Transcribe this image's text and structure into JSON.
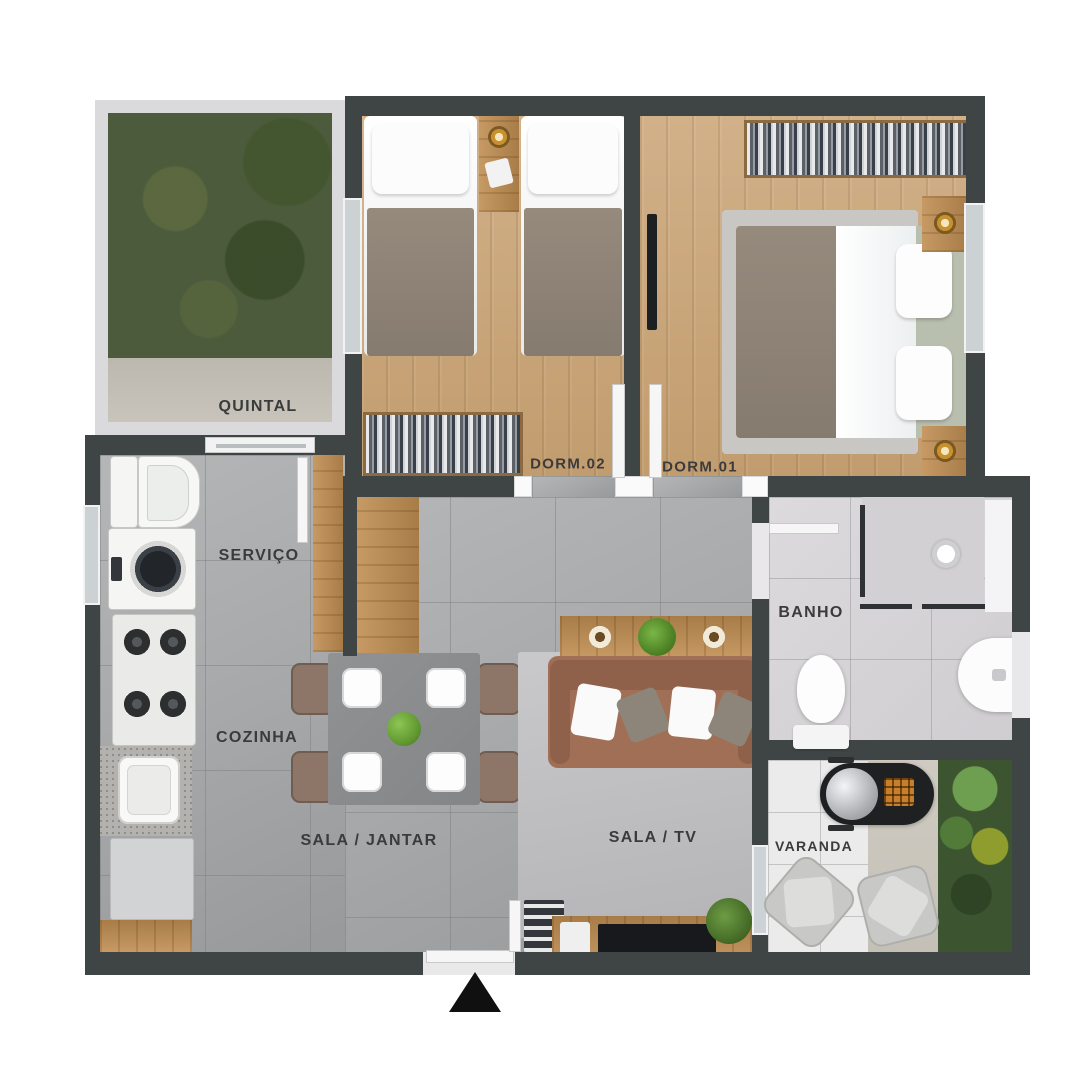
{
  "plan_type": "apartment-floor-plan-3d-top-view",
  "rooms": {
    "quintal": {
      "label": "QUINTAL"
    },
    "dorm02": {
      "label": "DORM.02"
    },
    "dorm01": {
      "label": "DORM.01"
    },
    "servico": {
      "label": "SERVIÇO"
    },
    "cozinha": {
      "label": "COZINHA"
    },
    "sala_jantar": {
      "label": "SALA / JANTAR"
    },
    "sala_tv": {
      "label": "SALA / TV"
    },
    "banho": {
      "label": "BANHO"
    },
    "varanda": {
      "label": "VARANDA"
    }
  },
  "entrance_marker": "up-arrow-triangle",
  "inventory": {
    "quintal": [
      "grass lawn",
      "concrete path",
      "low light-gray fence"
    ],
    "dorm02": [
      "single bed x2",
      "nightstand with lamp",
      "open wardrobe with hanging clothes"
    ],
    "dorm01": [
      "double bed",
      "area rug",
      "hanging clothes rack",
      "nightstand with lamp x2",
      "wall tv"
    ],
    "servico": [
      "laundry tub",
      "washing machine",
      "cabinet"
    ],
    "cozinha": [
      "4-burner stove",
      "granite counter with sink",
      "refrigerator",
      "wood peninsula cabinet"
    ],
    "sala_jantar": [
      "dining table for four",
      "white plates x4",
      "green centerpiece",
      "chairs x4"
    ],
    "sala_tv": [
      "3-seat sofa",
      "console table with plants",
      "rug",
      "tv rack with tv",
      "bookshelf",
      "potted plant"
    ],
    "banho": [
      "corner glass shower",
      "shower head",
      "toilet",
      "wall-mounted round sink"
    ],
    "varanda": [
      "barbecue grill",
      "armchair x2",
      "garden bed with shrubs"
    ]
  },
  "colors": {
    "wall": "#3f4445",
    "wood_floor": "#c9a77c",
    "gray_tile_floor": "#a8aaab",
    "bath_floor": "#d6d4d6",
    "grass": "#4b5b3b",
    "concrete": "#c6c2b8",
    "label_text": "#3b3b3b",
    "plant_green": "#6aa83c",
    "sofa_brown": "#a06f55",
    "entrance_arrow": "#101010"
  }
}
